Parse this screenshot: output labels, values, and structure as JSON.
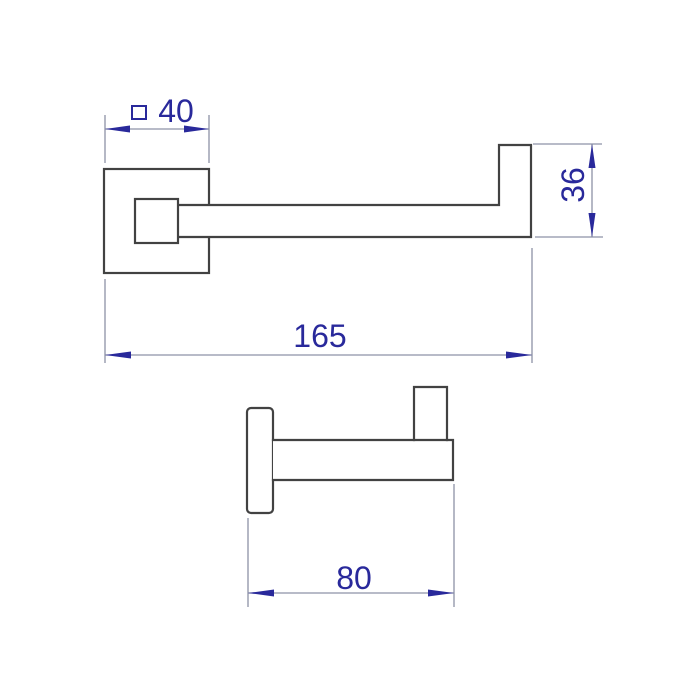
{
  "colors": {
    "background": "#ffffff",
    "object_line": "#424242",
    "dim_line": "#8d92a6",
    "dim_accent": "#29299b"
  },
  "dimensions": {
    "plate_size": {
      "symbol": "□",
      "value": "40"
    },
    "overall_length": {
      "value": "165"
    },
    "end_height": {
      "value": "36"
    },
    "wall_projection": {
      "value": "80"
    }
  }
}
